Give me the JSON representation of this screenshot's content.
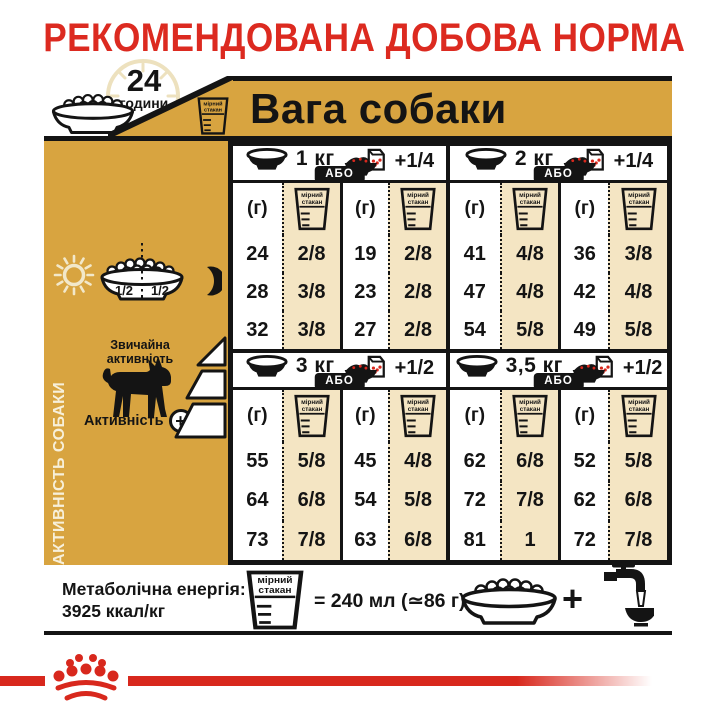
{
  "title": "РЕКОМЕНДОВАНА ДОБОВА НОРМА",
  "top": {
    "hours_value": "24",
    "hours_unit": "години",
    "weight_header": "Вага собаки"
  },
  "cup_icon": {
    "line1": "мірний",
    "line2": "стакан"
  },
  "sidebar": {
    "vertical_label": "АКТИВНІСТЬ СОБАКИ",
    "bowl_left_half": "1/2",
    "bowl_right_half": "1/2",
    "normal_activity": "Звичайна активність",
    "activity": "Активність",
    "activity_plus": "+"
  },
  "table": {
    "or_label": "АБО",
    "grams_unit": "(г)",
    "sections": [
      {
        "weight": "1 кг",
        "extra": "+1/4",
        "dry": {
          "grams": [
            "24",
            "28",
            "32"
          ],
          "cups": [
            "2/8",
            "3/8",
            "3/8"
          ]
        },
        "mixed": {
          "grams": [
            "19",
            "23",
            "27"
          ],
          "cups": [
            "2/8",
            "2/8",
            "2/8"
          ]
        }
      },
      {
        "weight": "2 кг",
        "extra": "+1/4",
        "dry": {
          "grams": [
            "41",
            "47",
            "54"
          ],
          "cups": [
            "4/8",
            "4/8",
            "5/8"
          ]
        },
        "mixed": {
          "grams": [
            "36",
            "42",
            "49"
          ],
          "cups": [
            "3/8",
            "4/8",
            "5/8"
          ]
        }
      },
      {
        "weight": "3 кг",
        "extra": "+1/2",
        "dry": {
          "grams": [
            "55",
            "64",
            "73"
          ],
          "cups": [
            "5/8",
            "6/8",
            "7/8"
          ]
        },
        "mixed": {
          "grams": [
            "45",
            "54",
            "63"
          ],
          "cups": [
            "4/8",
            "5/8",
            "6/8"
          ]
        }
      },
      {
        "weight": "3,5 кг",
        "extra": "+1/2",
        "dry": {
          "grams": [
            "62",
            "72",
            "81"
          ],
          "cups": [
            "6/8",
            "7/8",
            "1"
          ]
        },
        "mixed": {
          "grams": [
            "52",
            "62",
            "72"
          ],
          "cups": [
            "5/8",
            "6/8",
            "7/8"
          ]
        }
      }
    ]
  },
  "footer": {
    "energy_label": "Метаболічна енергія:",
    "energy_value": "3925 ккал/кг",
    "cup_equation": "= 240 мл (≃86 г)",
    "plus": "+"
  },
  "colors": {
    "red": "#DC2A20",
    "gold": "#D8A440",
    "tan": "#F4E5C3",
    "ink": "#141414",
    "cream": "#EDE1BE"
  },
  "chart_data": {
    "type": "table",
    "title": "РЕКОМЕНДОВАНА ДОБОВА НОРМА",
    "group_header": "Вага собаки",
    "column_units": [
      "(г)",
      "мірний стакан",
      "(г)",
      "мірний стакан"
    ],
    "or_label": "АБО",
    "sections": [
      {
        "weight": "1 кг",
        "wet_supplement": "+1/4",
        "rows": [
          [
            24,
            "2/8",
            19,
            "2/8"
          ],
          [
            28,
            "3/8",
            23,
            "2/8"
          ],
          [
            32,
            "3/8",
            27,
            "2/8"
          ]
        ]
      },
      {
        "weight": "2 кг",
        "wet_supplement": "+1/4",
        "rows": [
          [
            41,
            "4/8",
            36,
            "3/8"
          ],
          [
            47,
            "4/8",
            42,
            "4/8"
          ],
          [
            54,
            "5/8",
            49,
            "5/8"
          ]
        ]
      },
      {
        "weight": "3 кг",
        "wet_supplement": "+1/2",
        "rows": [
          [
            55,
            "5/8",
            45,
            "4/8"
          ],
          [
            64,
            "6/8",
            54,
            "5/8"
          ],
          [
            73,
            "7/8",
            63,
            "6/8"
          ]
        ]
      },
      {
        "weight": "3,5 кг",
        "wet_supplement": "+1/2",
        "rows": [
          [
            62,
            "6/8",
            52,
            "5/8"
          ],
          [
            72,
            "7/8",
            62,
            "6/8"
          ],
          [
            81,
            "1",
            72,
            "7/8"
          ]
        ]
      }
    ],
    "row_labels": [
      "Звичайна активність",
      "Активність +"
    ],
    "notes": [
      "Метаболічна енергія: 3925 ккал/кг",
      "мірний стакан = 240 мл (≃86 г)",
      "24 години"
    ]
  }
}
